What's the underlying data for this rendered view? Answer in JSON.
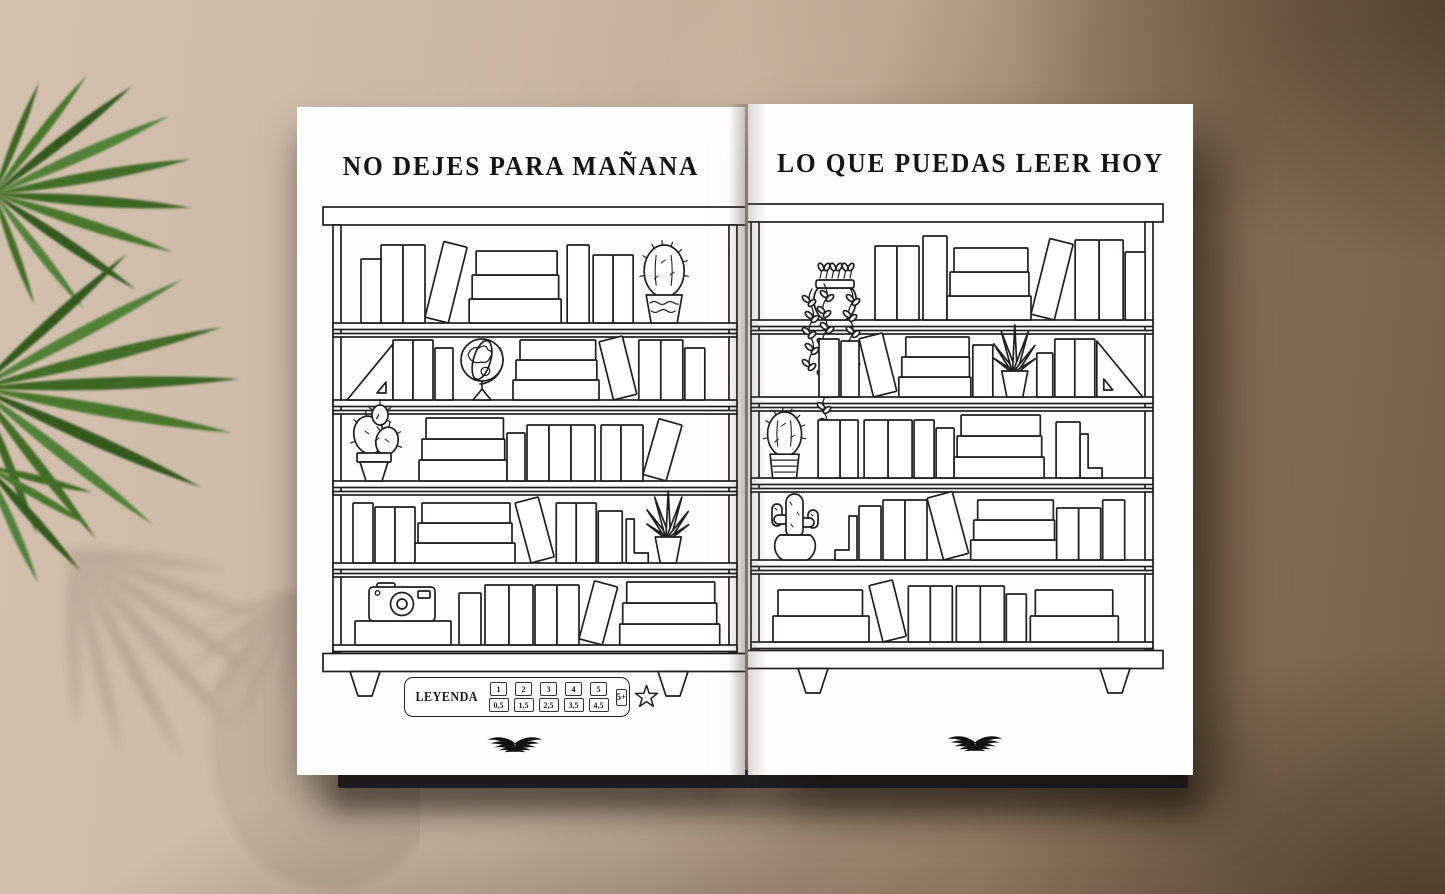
{
  "scene": {
    "background_base": "#cbb7a4",
    "background_dark": "#74604a",
    "page_color": "#ffffff",
    "line_color": "#1f1f1f",
    "plant_leaf_color": "#3e6b28",
    "logo": "wings-logo"
  },
  "pages": {
    "left": {
      "title": "NO DEJES PARA MAÑANA",
      "shelves": [
        [
          {
            "t": "g",
            "w": 16
          },
          {
            "t": "v",
            "w": 20,
            "h": 64
          },
          {
            "t": "v",
            "w": 22,
            "h": 78
          },
          {
            "t": "v",
            "w": 22,
            "h": 78
          },
          {
            "t": "t",
            "w": 24,
            "h": 78,
            "r": 14
          },
          {
            "t": "s",
            "w": 92,
            "bh": 24
          },
          {
            "t": "g",
            "w": 6
          },
          {
            "t": "v",
            "w": 22,
            "h": 78
          },
          {
            "t": "g",
            "w": 4
          },
          {
            "t": "v",
            "w": 20,
            "h": 68
          },
          {
            "t": "v",
            "w": 20,
            "h": 68
          },
          {
            "t": "g",
            "w": 8
          },
          {
            "t": "round",
            "pot": "wavy",
            "sz": 1
          }
        ],
        [
          {
            "t": "g",
            "w": 2
          },
          {
            "t": "tri",
            "d": 1
          },
          {
            "t": "v",
            "w": 20,
            "h": 60
          },
          {
            "t": "v",
            "w": 20,
            "h": 60
          },
          {
            "t": "g",
            "w": 2
          },
          {
            "t": "v",
            "w": 18,
            "h": 52
          },
          {
            "t": "g",
            "w": 2
          },
          {
            "t": "globe"
          },
          {
            "t": "s",
            "w": 86,
            "bh": 20
          },
          {
            "t": "t",
            "w": 24,
            "h": 60,
            "r": -14
          },
          {
            "t": "v",
            "w": 22,
            "h": 60
          },
          {
            "t": "v",
            "w": 22,
            "h": 60
          },
          {
            "t": "g",
            "w": 2
          },
          {
            "t": "v",
            "w": 20,
            "h": 52
          }
        ],
        [
          {
            "t": "g",
            "w": 2
          },
          {
            "t": "pear"
          },
          {
            "t": "g",
            "w": 8
          },
          {
            "t": "s",
            "w": 88,
            "bh": 21
          },
          {
            "t": "v",
            "w": 18,
            "h": 48
          },
          {
            "t": "g",
            "w": 2
          },
          {
            "t": "v",
            "w": 22,
            "h": 56
          },
          {
            "t": "v",
            "w": 22,
            "h": 56
          },
          {
            "t": "v",
            "w": 24,
            "h": 56
          },
          {
            "t": "g",
            "w": 6
          },
          {
            "t": "v",
            "w": 20,
            "h": 56
          },
          {
            "t": "v",
            "w": 22,
            "h": 56
          },
          {
            "t": "t",
            "w": 24,
            "h": 58,
            "r": 16
          }
        ],
        [
          {
            "t": "g",
            "w": 8
          },
          {
            "t": "v",
            "w": 20,
            "h": 60
          },
          {
            "t": "g",
            "w": 2
          },
          {
            "t": "v",
            "w": 20,
            "h": 56
          },
          {
            "t": "v",
            "w": 20,
            "h": 56
          },
          {
            "t": "s",
            "w": 100,
            "bh": 20
          },
          {
            "t": "t",
            "w": 24,
            "h": 62,
            "r": -15
          },
          {
            "t": "v",
            "w": 20,
            "h": 60
          },
          {
            "t": "v",
            "w": 20,
            "h": 60
          },
          {
            "t": "g",
            "w": 2
          },
          {
            "t": "v",
            "w": 24,
            "h": 52
          },
          {
            "t": "g",
            "w": 4
          },
          {
            "t": "lbend",
            "d": 1
          },
          {
            "t": "aloe"
          }
        ],
        [
          {
            "t": "g",
            "w": 10
          },
          {
            "t": "camera",
            "w": 96
          },
          {
            "t": "g",
            "w": 8
          },
          {
            "t": "v",
            "w": 22,
            "h": 52
          },
          {
            "t": "g",
            "w": 4
          },
          {
            "t": "v",
            "w": 24,
            "h": 60
          },
          {
            "t": "v",
            "w": 24,
            "h": 60
          },
          {
            "t": "g",
            "w": 2
          },
          {
            "t": "v",
            "w": 22,
            "h": 60
          },
          {
            "t": "v",
            "w": 22,
            "h": 60
          },
          {
            "t": "t",
            "w": 24,
            "h": 60,
            "r": 15
          },
          {
            "t": "s",
            "w": 100,
            "bh": 21
          }
        ]
      ]
    },
    "right": {
      "title": "LO QUE PUEDAS LEER HOY",
      "shelves": [
        [
          {
            "t": "g",
            "w": 40
          },
          {
            "t": "hanging"
          },
          {
            "t": "g",
            "w": 8
          },
          {
            "t": "v",
            "w": 22,
            "h": 74
          },
          {
            "t": "v",
            "w": 22,
            "h": 74
          },
          {
            "t": "g",
            "w": 4
          },
          {
            "t": "v",
            "w": 24,
            "h": 84
          },
          {
            "t": "s",
            "w": 84,
            "bh": 24
          },
          {
            "t": "t",
            "w": 24,
            "h": 78,
            "r": 14
          },
          {
            "t": "v",
            "w": 24,
            "h": 80
          },
          {
            "t": "v",
            "w": 24,
            "h": 80
          },
          {
            "t": "g",
            "w": 2
          },
          {
            "t": "v",
            "w": 20,
            "h": 68
          }
        ],
        [
          {
            "t": "g",
            "w": 56
          },
          {
            "t": "v",
            "w": 20,
            "h": 58
          },
          {
            "t": "g",
            "w": 2
          },
          {
            "t": "v",
            "w": 18,
            "h": 56
          },
          {
            "t": "t",
            "w": 24,
            "h": 60,
            "r": -14
          },
          {
            "t": "s",
            "w": 72,
            "bh": 20
          },
          {
            "t": "g",
            "w": 2
          },
          {
            "t": "v",
            "w": 20,
            "h": 52
          },
          {
            "t": "g",
            "w": 2
          },
          {
            "t": "aloe"
          },
          {
            "t": "g",
            "w": 2
          },
          {
            "t": "v",
            "w": 16,
            "h": 44
          },
          {
            "t": "g",
            "w": 2
          },
          {
            "t": "v",
            "w": 20,
            "h": 58
          },
          {
            "t": "v",
            "w": 20,
            "h": 58
          },
          {
            "t": "g",
            "w": 2
          },
          {
            "t": "tri",
            "d": -1
          }
        ],
        [
          {
            "t": "g",
            "w": 2
          },
          {
            "t": "round",
            "pot": "striped",
            "sz": 0.85
          },
          {
            "t": "g",
            "w": 14
          },
          {
            "t": "v",
            "w": 22,
            "h": 58
          },
          {
            "t": "v",
            "w": 18,
            "h": 58
          },
          {
            "t": "g",
            "w": 6
          },
          {
            "t": "v",
            "w": 24,
            "h": 58
          },
          {
            "t": "v",
            "w": 24,
            "h": 58
          },
          {
            "t": "g",
            "w": 2
          },
          {
            "t": "v",
            "w": 20,
            "h": 58
          },
          {
            "t": "g",
            "w": 2
          },
          {
            "t": "v",
            "w": 18,
            "h": 50
          },
          {
            "t": "s",
            "w": 90,
            "bh": 21
          },
          {
            "t": "g",
            "w": 12
          },
          {
            "t": "v",
            "w": 24,
            "h": 56
          },
          {
            "t": "lbend",
            "d": 1
          }
        ],
        [
          {
            "t": "g",
            "w": 4
          },
          {
            "t": "saguaro"
          },
          {
            "t": "g",
            "w": 14
          },
          {
            "t": "lbend",
            "d": -1
          },
          {
            "t": "g",
            "w": 2
          },
          {
            "t": "v",
            "w": 22,
            "h": 54
          },
          {
            "t": "g",
            "w": 2
          },
          {
            "t": "v",
            "w": 22,
            "h": 60
          },
          {
            "t": "v",
            "w": 22,
            "h": 60
          },
          {
            "t": "t",
            "w": 26,
            "h": 64,
            "r": -15
          },
          {
            "t": "s",
            "w": 86,
            "bh": 20
          },
          {
            "t": "v",
            "w": 22,
            "h": 52
          },
          {
            "t": "v",
            "w": 22,
            "h": 52
          },
          {
            "t": "g",
            "w": 2
          },
          {
            "t": "v",
            "w": 22,
            "h": 60
          }
        ],
        [
          {
            "t": "g",
            "w": 10
          },
          {
            "t": "s",
            "w": 96,
            "n": 2,
            "bh": 26
          },
          {
            "t": "t",
            "w": 24,
            "h": 58,
            "r": -14
          },
          {
            "t": "v",
            "w": 22,
            "h": 56
          },
          {
            "t": "v",
            "w": 22,
            "h": 56
          },
          {
            "t": "g",
            "w": 4
          },
          {
            "t": "v",
            "w": 24,
            "h": 56
          },
          {
            "t": "v",
            "w": 24,
            "h": 56
          },
          {
            "t": "g",
            "w": 2
          },
          {
            "t": "v",
            "w": 20,
            "h": 48
          },
          {
            "t": "g",
            "w": 4
          },
          {
            "t": "s",
            "w": 88,
            "n": 2,
            "bh": 26
          }
        ]
      ]
    }
  },
  "legend": {
    "label": "LEYENDA",
    "cells": [
      {
        "top": "1",
        "bottom": "0,5"
      },
      {
        "top": "2",
        "bottom": "1,5"
      },
      {
        "top": "3",
        "bottom": "2,5"
      },
      {
        "top": "4",
        "bottom": "3,5"
      },
      {
        "top": "5",
        "bottom": "4,5"
      }
    ],
    "plus": "5+",
    "star": "star-icon"
  }
}
